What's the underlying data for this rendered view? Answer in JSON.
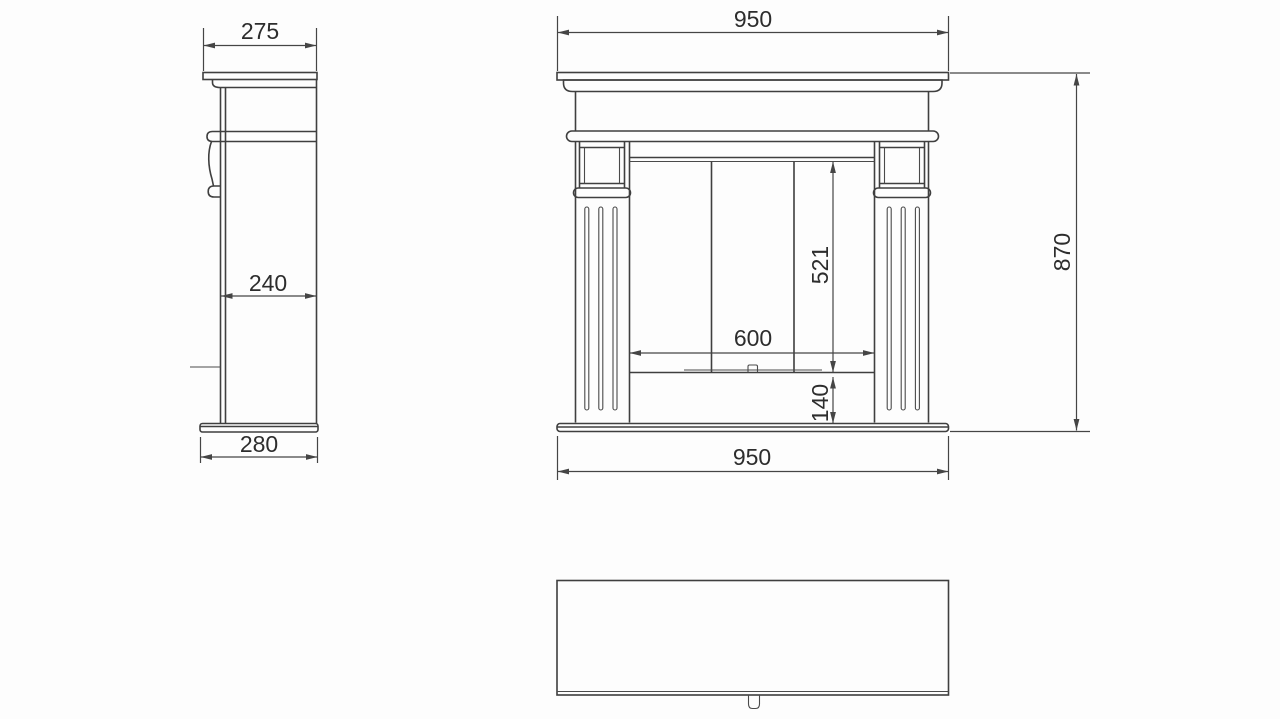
{
  "drawing": {
    "type": "furniture-technical-drawing",
    "subject": "fireplace-mantel-three-views",
    "background_color": "#fdfdfd",
    "line_color": "#3f3f3f",
    "dimension_line_color": "#454545",
    "text_color": "#2d2d2d",
    "views": {
      "side_view": {
        "dimensions": {
          "shelf_depth": "275",
          "body_depth": "240",
          "base_depth": "280"
        }
      },
      "front_view": {
        "dimensions": {
          "shelf_width": "950",
          "opening_height": "521",
          "opening_width": "600",
          "hearth_height": "140",
          "total_height": "870",
          "base_width": "950"
        }
      },
      "top_view": {
        "dimensions": {}
      }
    }
  }
}
